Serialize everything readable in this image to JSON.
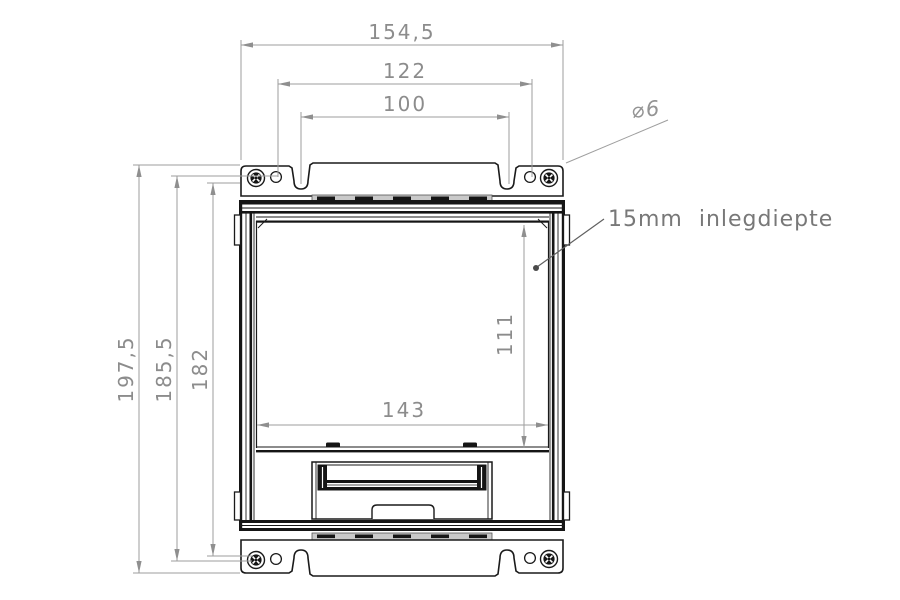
{
  "drawing": {
    "background": "#ffffff",
    "part_line_color": "#1a1a1a",
    "dimension_line_color": "#9e9e9e",
    "dimension_text_color": "#8c8c8c",
    "dimensions": {
      "overall_width": "154,5",
      "hole_spacing_width": "122",
      "slot_spacing_width": "100",
      "overall_height": "197,5",
      "hole_spacing_height": "185,5",
      "frame_height": "182",
      "opening_height": "111",
      "opening_width": "143",
      "hole_diameter": "⌀6"
    },
    "note": "15mm  inlegdiepte"
  }
}
